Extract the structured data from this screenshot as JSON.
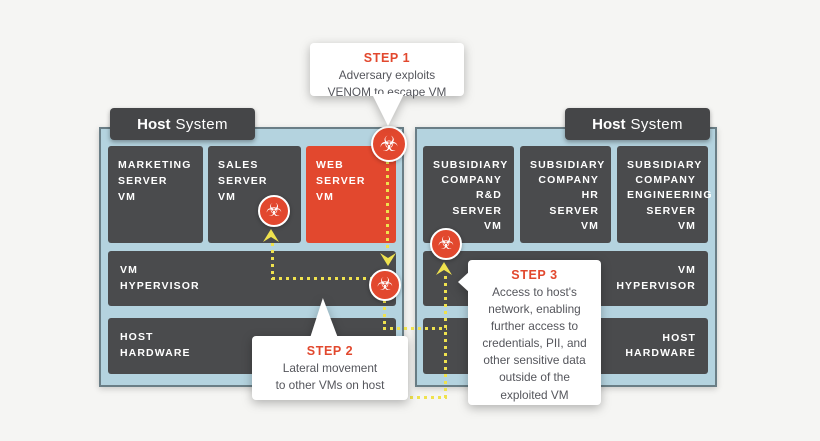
{
  "colors": {
    "background": "#f5f5f3",
    "host_fill": "#b4d3df",
    "host_border": "#6a7e86",
    "box_dark": "#4a4b4d",
    "infected_red": "#e2482e",
    "path_yellow": "#efe24e",
    "callout_bg": "#ffffff",
    "step_title": "#e2482e",
    "body_text": "#55565c",
    "label_bg": "#454648"
  },
  "icons": {
    "biohazard": "☣"
  },
  "hosts": [
    {
      "label": {
        "bold": "Host",
        "regular": "System"
      },
      "vms": [
        {
          "label": "MARKETING\nSERVER\nVM"
        },
        {
          "label": "SALES\nSERVER\nVM"
        },
        {
          "label": "WEB\nSERVER\nVM"
        }
      ],
      "hypervisor": {
        "label": "VM\nHYPERVISOR"
      },
      "hardware": {
        "label": "HOST\nHARDWARE"
      }
    },
    {
      "label": {
        "bold": "Host",
        "regular": "System"
      },
      "vms": [
        {
          "label": "SUBSIDIARY\nCOMPANY R&D\nSERVER\nVM"
        },
        {
          "label": "SUBSIDIARY\nCOMPANY HR\nSERVER\nVM"
        },
        {
          "label": "SUBSIDIARY\nCOMPANY\nENGINEERING\nSERVER\nVM"
        }
      ],
      "hypervisor": {
        "label": "VM\nHYPERVISOR"
      },
      "hardware": {
        "label": "HOST\nHARDWARE"
      }
    }
  ],
  "callouts": [
    {
      "title": "STEP 1",
      "body": "Adversary exploits\nVENOM to escape VM"
    },
    {
      "title": "STEP 2",
      "body": "Lateral movement\nto other VMs on host"
    },
    {
      "title": "STEP 3",
      "body": "Access to host's\nnetwork, enabling\nfurther access to\ncredentials, PII, and\nother sensitive data\noutside of the\nexploited VM"
    }
  ]
}
